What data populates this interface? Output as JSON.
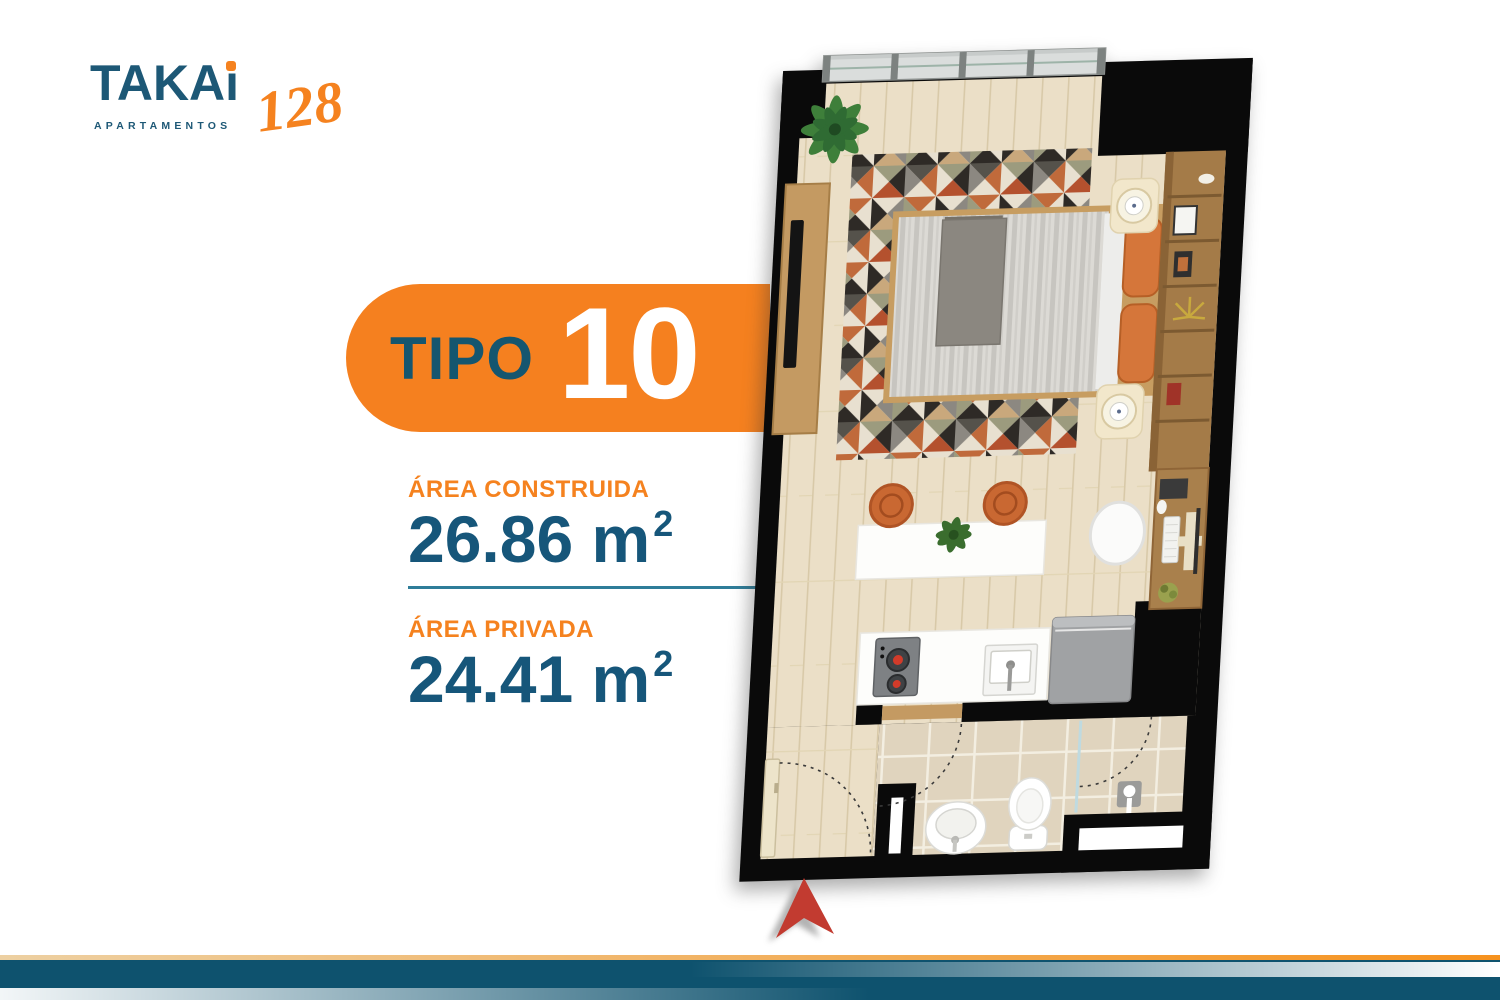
{
  "brand": {
    "name_head": "TAKA",
    "name_i": "i",
    "number": "128",
    "tagline": "APARTAMENTOS"
  },
  "badge": {
    "label": "TIPO",
    "value": "10"
  },
  "areas": {
    "built": {
      "label": "ÁREA CONSTRUIDA",
      "value": "26.86",
      "unit": "m",
      "sup": "2"
    },
    "private": {
      "label": "ÁREA PRIVADA",
      "value": "24.41",
      "unit": "m",
      "sup": "2"
    }
  },
  "colors": {
    "orange": "#F5821F",
    "teal_text": "#16567A",
    "badge_orange": "#F5801F",
    "divider_teal": "#2F7D99",
    "bar_navy": "#0E526E",
    "north_arrow_red": "#C23B30",
    "wall_black": "#0A0A0A",
    "wood_floor": "#EBDFC7",
    "bath_tile": "#E0D4BE"
  },
  "floorplan": {
    "elements": [
      "balcony-window",
      "plant",
      "tv-console",
      "tv",
      "geometric-rug",
      "bed",
      "pillows",
      "nightstands",
      "lamps",
      "shelving",
      "desk",
      "desk-chair",
      "keyboard",
      "monitor",
      "dining-table",
      "stools",
      "table-plant",
      "kitchen-counter",
      "stove",
      "kitchen-sink",
      "fridge",
      "bathroom",
      "toilet",
      "washbasin",
      "shower",
      "glass-partition",
      "entry-door",
      "door-swing-arcs",
      "wall-niche",
      "north-arrow"
    ]
  }
}
